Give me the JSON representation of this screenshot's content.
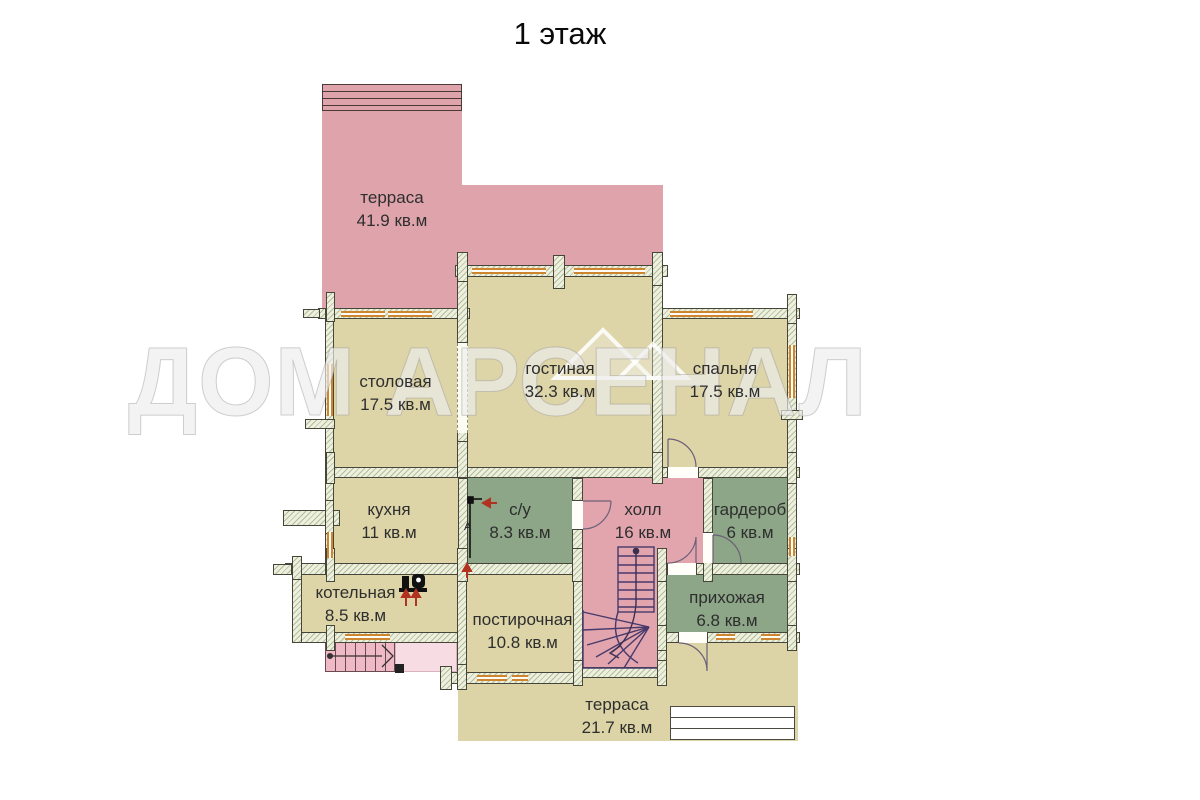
{
  "title": "1 этаж",
  "watermark": "ДОМ АРСЕНАЛ",
  "annotations": {
    "duct_label": "А"
  },
  "floor_plan": {
    "rooms": [
      {
        "id": "terrace-top",
        "name": "терраса",
        "area": "41.9 кв.м"
      },
      {
        "id": "dining",
        "name": "столовая",
        "area": "17.5 кв.м"
      },
      {
        "id": "living",
        "name": "гостиная",
        "area": "32.3 кв.м"
      },
      {
        "id": "bedroom",
        "name": "спальня",
        "area": "17.5 кв.м"
      },
      {
        "id": "kitchen",
        "name": "кухня",
        "area": "11 кв.м"
      },
      {
        "id": "bathroom",
        "name": "с/у",
        "area": "8.3 кв.м"
      },
      {
        "id": "hall",
        "name": "холл",
        "area": "16 кв.м"
      },
      {
        "id": "wardrobe",
        "name": "гардероб",
        "area": "6 кв.м"
      },
      {
        "id": "boiler-room",
        "name": "котельная",
        "area": "8.5 кв.м"
      },
      {
        "id": "laundry",
        "name": "постирочная",
        "area": "10.8 кв.м"
      },
      {
        "id": "entry",
        "name": "прихожая",
        "area": "6.8 кв.м"
      },
      {
        "id": "terrace-bottom",
        "name": "терраса",
        "area": "21.7 кв.м"
      }
    ],
    "colors": {
      "room_beige": "#ddd5a8",
      "room_green": "#8ca687",
      "terrace_pink": "#dfa3ac",
      "hall_pink": "#e2a5ae",
      "wall_fill": "#edf0df",
      "wall_outline": "#45453a",
      "window_orange": "#cd8530",
      "stair_stroke": "#473a6b",
      "exterior_steps_pink": "#f0b9c6",
      "landing_pink": "#f8dce4",
      "arrow_red": "#b23222"
    }
  }
}
